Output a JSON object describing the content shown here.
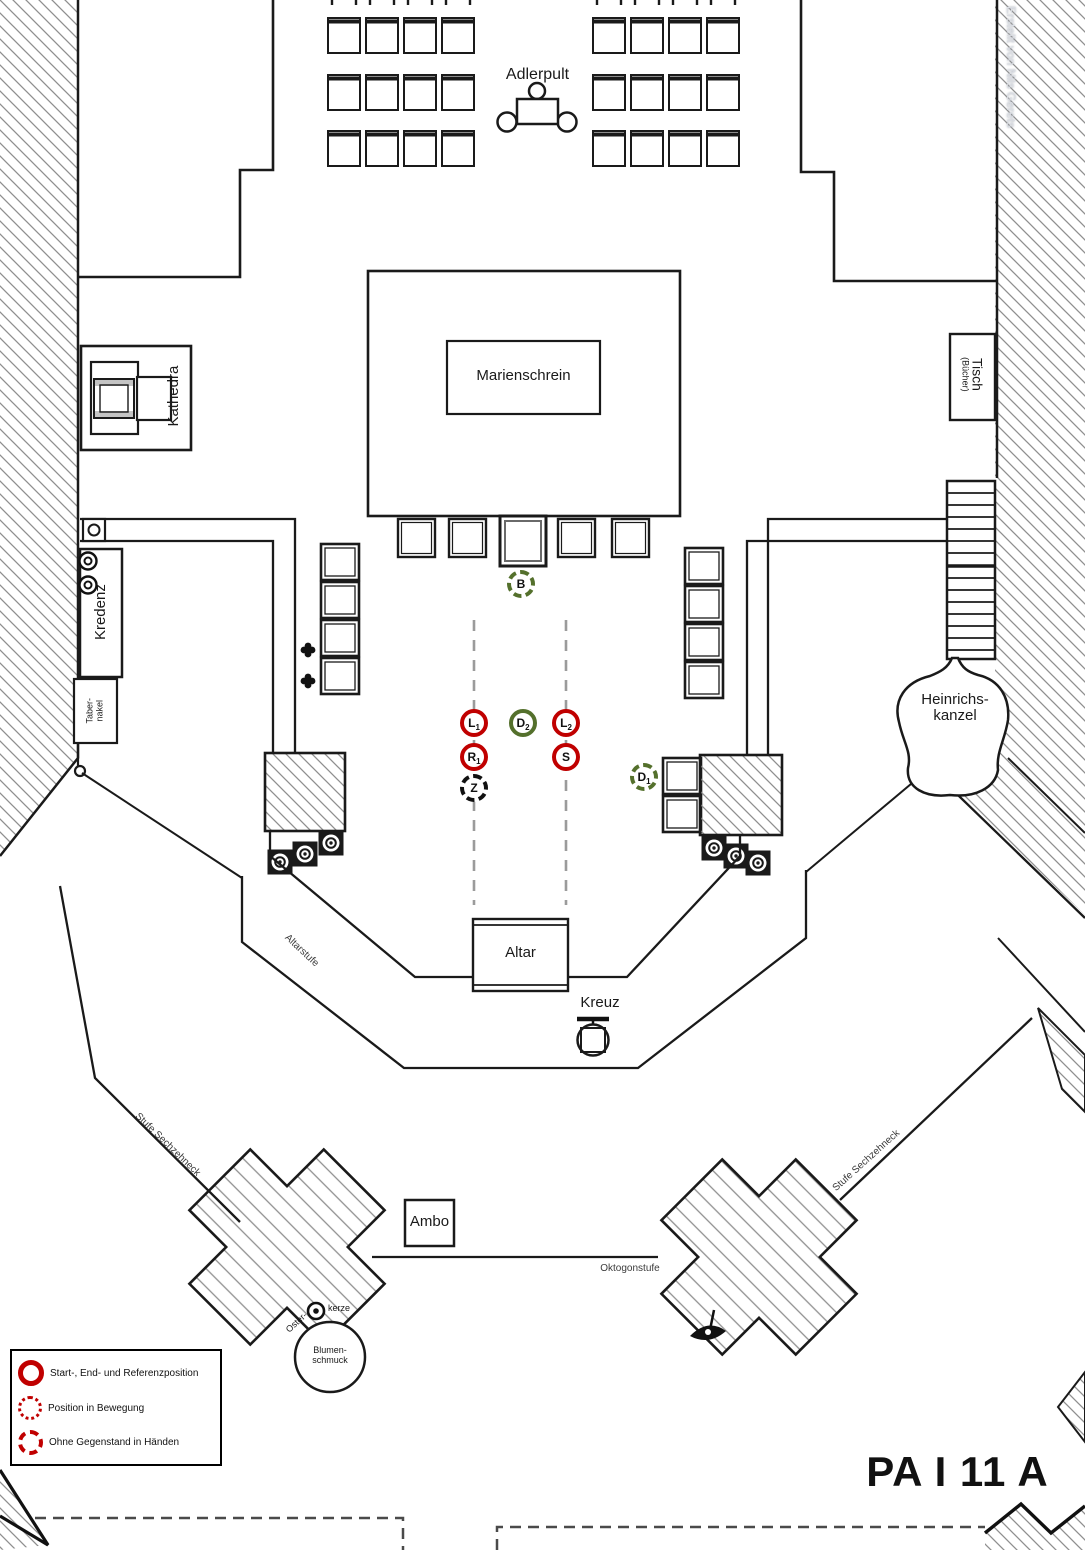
{
  "title": "PA I 11 A",
  "credit": "Erstellt von Nils Gerets",
  "colors": {
    "marker_red": "#C00000",
    "marker_green": "#54702C",
    "marker_black": "#111111",
    "line_black": "#1a1a1a",
    "hatch_gray": "#8f8f8f",
    "guide_gray": "#9b9b9b"
  },
  "rooms": {
    "adlerpult": "Adlerpult",
    "marienschrein": "Marienschrein",
    "kathedra": "Kathedra",
    "tisch": "Tisch",
    "tisch_sub": "(Bücher)",
    "kredenz": "Kredenz",
    "tabernakel_line1": "Taber-",
    "tabernakel_line2": "nakel",
    "heinrichskanzel_line1": "Heinrichs-",
    "heinrichskanzel_line2": "kanzel",
    "altar": "Altar",
    "kreuz": "Kreuz",
    "altarstufe": "Altarstufe",
    "stufe_sechzehneck_left": "Stufe Sechzehneck",
    "stufe_sechzehneck_right": "Stufe Sechzehneck",
    "oktogonstufe": "Oktogonstufe",
    "ambo": "Ambo",
    "osterkerze_line1": "Oster-",
    "osterkerze_line2": "kerze",
    "blumenschmuck_line1": "Blumen-",
    "blumenschmuck_line2": "schmuck"
  },
  "positions": [
    {
      "id": "B",
      "label": "B",
      "sub": "",
      "style": "green-dashed"
    },
    {
      "id": "L1",
      "label": "L",
      "sub": "1",
      "style": "red-solid"
    },
    {
      "id": "D2",
      "label": "D",
      "sub": "2",
      "style": "green-solid"
    },
    {
      "id": "L2",
      "label": "L",
      "sub": "2",
      "style": "red-solid"
    },
    {
      "id": "R1",
      "label": "R",
      "sub": "1",
      "style": "red-solid"
    },
    {
      "id": "S",
      "label": "S",
      "sub": "",
      "style": "red-solid"
    },
    {
      "id": "Z",
      "label": "Z",
      "sub": "",
      "style": "black-dashed"
    },
    {
      "id": "D1",
      "label": "D",
      "sub": "1",
      "style": "green-dashed"
    }
  ],
  "legend": {
    "items": [
      {
        "style": "solid",
        "text": "Start-, End- und Referenzposition"
      },
      {
        "style": "dotted",
        "text": "Position in Bewegung"
      },
      {
        "style": "dashed",
        "text": "Ohne Gegenstand in Händen"
      }
    ]
  }
}
